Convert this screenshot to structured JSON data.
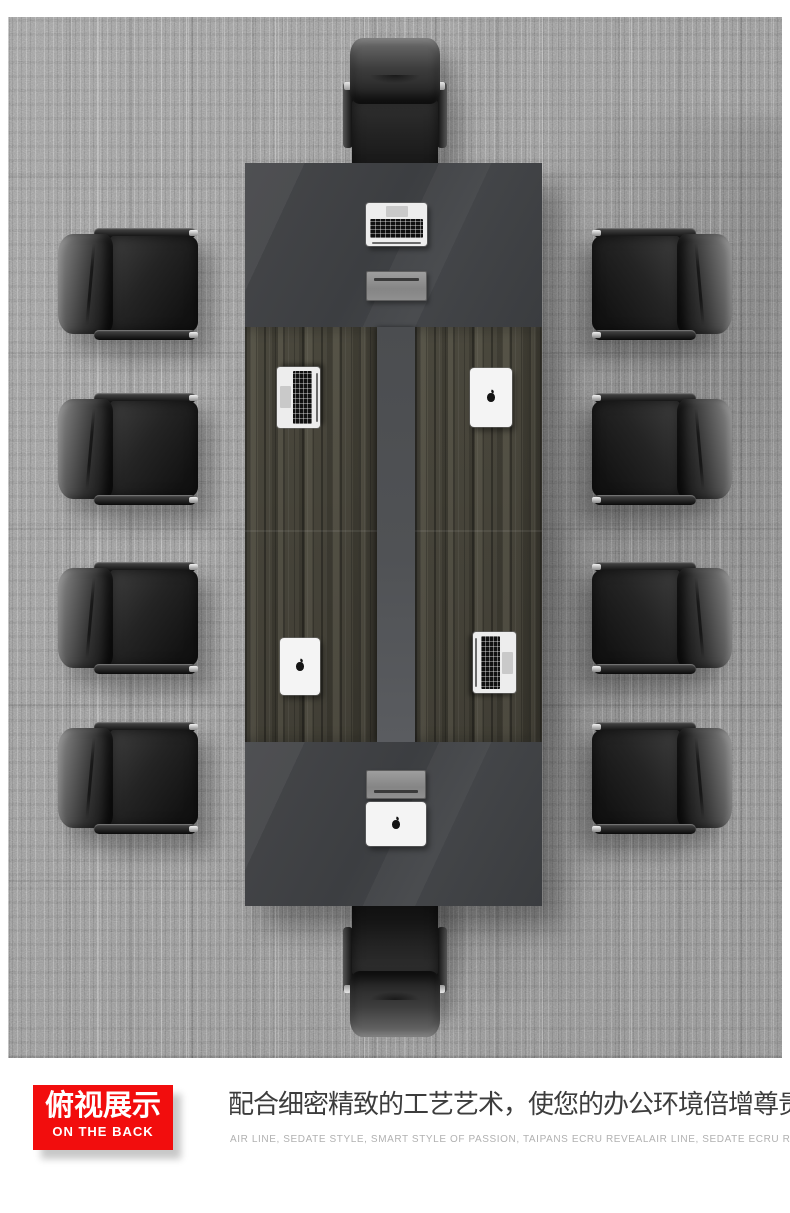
{
  "badge": {
    "title": "俯视展示",
    "subtitle": "ON THE BACK"
  },
  "caption": {
    "headline": "配合细密精致的工艺艺术，使您的办公环境倍增尊贵气派",
    "subline": "AIR LINE, SEDATE STYLE, SMART STYLE OF PASSION, TAIPANS ECRU REVEALAIR LINE, SEDATE ECRU REVEAL"
  },
  "colors": {
    "badge_red": "#f20d0d",
    "badge_text": "#ffffff",
    "headline_gray": "#3c3c3c",
    "subline_gray": "#b1b1b1",
    "table_gray": "#414346",
    "table_runner_gray": "#535558",
    "wood_brown_gray": "#4b4840",
    "carpet_gray": "#9a9a9a"
  },
  "scene": {
    "description": "top view of dark conference table with ten black leather chairs on gray carpet",
    "chairs_total": 10,
    "devices": [
      "open-laptop",
      "cable-box",
      "open-laptop",
      "closed-tablet",
      "closed-tablet",
      "open-laptop",
      "cable-box",
      "closed-laptop"
    ]
  }
}
